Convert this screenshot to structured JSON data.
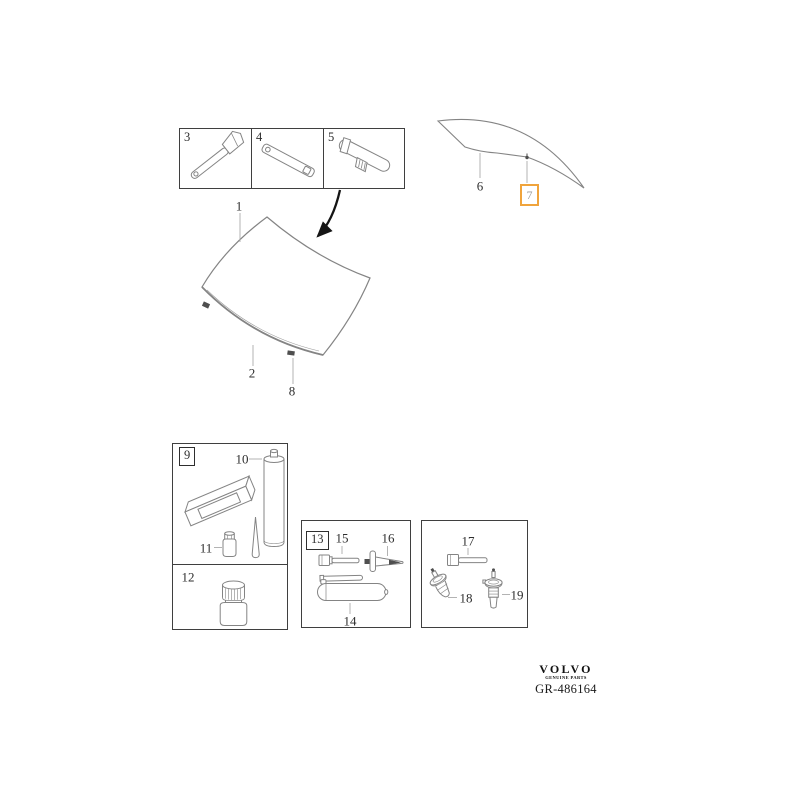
{
  "colors": {
    "line": "#848484",
    "box_border": "#3f3f3f",
    "label": "#2e2e2e",
    "leader": "#ababab",
    "arrow": "#151515",
    "highlight": "#F0A43C",
    "highlight_text": "#9b9b9b",
    "dark_fill": "#4f4f4f"
  },
  "top_box": {
    "cells": [
      {
        "num": "3",
        "icon": "applicator-stick-icon"
      },
      {
        "num": "4",
        "icon": "retainer-strip-icon"
      },
      {
        "num": "5",
        "icon": "retainer-clip-icon"
      }
    ]
  },
  "diagram": {
    "windshield": {
      "num": "1"
    },
    "moulding": {
      "num": "2"
    },
    "windshield_clip": {
      "num": "8"
    },
    "side_glass": {
      "num": "6"
    },
    "side_glass_clip": {
      "num": "7",
      "highlighted": true
    }
  },
  "kit_box": {
    "group_num": "9",
    "cartridge_num": "10",
    "small_bottle_num": "11",
    "bottle_num": "12"
  },
  "tool_box": {
    "group_num": "13",
    "tube_num": "14",
    "screw_num": "15",
    "plug_num": "16"
  },
  "nozzle_box": {
    "screw_num": "17",
    "nozzle_left_num": "18",
    "nozzle_right_num": "19"
  },
  "footer": {
    "brand": "VOLVO",
    "tagline": "GENUINE PARTS",
    "reference": "GR-486164"
  }
}
